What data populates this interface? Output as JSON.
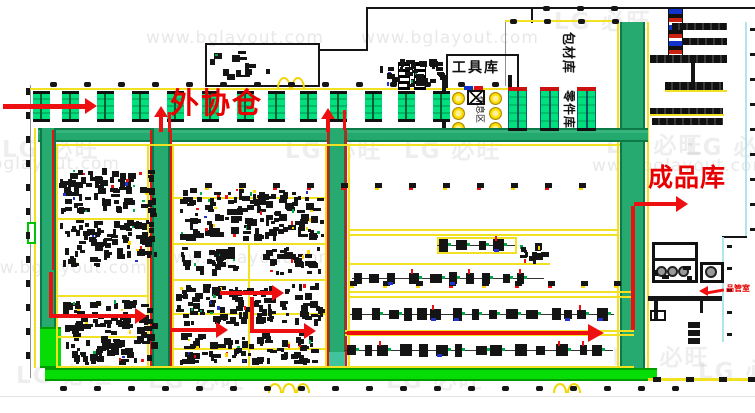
{
  "labels": {
    "outsourcing": "外协仓",
    "finished_goods": "成品库",
    "tools": "工具库",
    "packaging": "包材库",
    "parts": "零件库",
    "rest": "休息区",
    "quality": "品管室"
  },
  "watermark": {
    "url": "www.bglayout.com",
    "logo": "必旺",
    "url_positions": [
      [
        -58,
        154
      ],
      [
        146,
        28
      ],
      [
        361,
        28
      ],
      [
        592,
        156
      ],
      [
        -30,
        258
      ],
      [
        158,
        248
      ]
    ],
    "logo_positions": [
      [
        2,
        130
      ],
      [
        285,
        131
      ],
      [
        404,
        131
      ],
      [
        554,
        2
      ],
      [
        606,
        126
      ],
      [
        686,
        128
      ],
      [
        16,
        356
      ],
      [
        148,
        361
      ],
      [
        386,
        361
      ],
      [
        612,
        338
      ],
      [
        698,
        352
      ]
    ]
  },
  "colors": {
    "aisle_green": "#27aa70",
    "aisle_green_dark": "#0c7a47",
    "bright_green": "#06dc06",
    "zone_yellow": "#f2e120",
    "arrow_red": "#ee1010",
    "machine_green": "#00e07c",
    "accent_blue": "#2233cc",
    "accent_yellow": "#ffd700",
    "accent_dgreen": "#00aa44"
  },
  "top_machines": {
    "xs": [
      33,
      62,
      97,
      132,
      167,
      202,
      237,
      268,
      300,
      330,
      365,
      398,
      433
    ],
    "y": 91,
    "w": 17,
    "h": 31
  },
  "parts_machines": {
    "xs": [
      508,
      540,
      577
    ],
    "y": 87,
    "w": 19,
    "h": 44
  },
  "dot_rows": [
    {
      "y": 82,
      "x0": 50,
      "step": 34,
      "count": 14,
      "w": 7,
      "h": 5
    },
    {
      "y": 19,
      "x0": 510,
      "step": 34,
      "count": 4,
      "w": 7,
      "h": 5
    },
    {
      "y": 6,
      "x0": 543,
      "step": 34,
      "count": 3,
      "w": 7,
      "h": 5
    },
    {
      "y": 386,
      "x0": 60,
      "step": 34,
      "count": 19,
      "w": 7,
      "h": 5
    }
  ],
  "mark_rows": [
    {
      "y": 183,
      "x0": 205,
      "step": 34,
      "count": 12
    },
    {
      "y": 281,
      "x0": 350,
      "step": 33,
      "count": 9
    }
  ],
  "clusters": [
    {
      "x": 58,
      "y": 168,
      "w": 100,
      "h": 50,
      "type": "scatter",
      "seed": 11
    },
    {
      "x": 58,
      "y": 220,
      "w": 102,
      "h": 48,
      "type": "scatter",
      "seed": 22
    },
    {
      "x": 62,
      "y": 300,
      "w": 98,
      "h": 66,
      "type": "scatter",
      "seed": 33
    },
    {
      "x": 178,
      "y": 188,
      "w": 148,
      "h": 54,
      "type": "scatter",
      "seed": 44
    },
    {
      "x": 178,
      "y": 247,
      "w": 62,
      "h": 30,
      "type": "scatter",
      "seed": 55
    },
    {
      "x": 262,
      "y": 247,
      "w": 62,
      "h": 30,
      "type": "scatter",
      "seed": 66
    },
    {
      "x": 176,
      "y": 283,
      "w": 150,
      "h": 44,
      "type": "scatter",
      "seed": 77
    },
    {
      "x": 178,
      "y": 333,
      "w": 148,
      "h": 33,
      "type": "scatter",
      "seed": 88
    },
    {
      "x": 517,
      "y": 243,
      "w": 34,
      "h": 24,
      "type": "scatter",
      "seed": 99
    },
    {
      "x": 350,
      "y": 300,
      "w": 264,
      "h": 29,
      "type": "hline",
      "seed": 101
    },
    {
      "x": 345,
      "y": 336,
      "w": 268,
      "h": 29,
      "type": "hline",
      "seed": 102
    },
    {
      "x": 437,
      "y": 238,
      "w": 78,
      "h": 15,
      "type": "hline",
      "seed": 103
    },
    {
      "x": 352,
      "y": 267,
      "w": 192,
      "h": 23,
      "type": "hline",
      "seed": 104
    },
    {
      "x": 380,
      "y": 57,
      "w": 66,
      "h": 32,
      "type": "scatter",
      "seed": 105
    },
    {
      "x": 210,
      "y": 48,
      "w": 62,
      "h": 34,
      "type": "sparse",
      "seed": 106
    },
    {
      "x": 655,
      "y": 265,
      "w": 40,
      "h": 16,
      "type": "sparse",
      "seed": 107
    }
  ],
  "racks": [
    [
      672,
      23,
      55,
      7
    ],
    [
      683,
      38,
      44,
      7
    ],
    [
      650,
      55,
      77,
      8
    ],
    [
      665,
      82,
      58,
      8
    ],
    [
      650,
      108,
      73,
      8
    ],
    [
      652,
      118,
      71,
      7
    ]
  ],
  "rack_lines": [
    [
      665,
      90,
      62
    ],
    [
      650,
      114,
      74
    ]
  ],
  "right_ticks": [
    {
      "x": 750,
      "y0": 28,
      "step": 25,
      "count": 9
    },
    {
      "x": 727,
      "y0": 245,
      "step": 22,
      "count": 5
    }
  ],
  "left_dashes": {
    "x": 26,
    "y0": 88,
    "step": 24,
    "count": 12
  },
  "bottom_right_dashes": [
    653,
    686,
    719,
    748
  ]
}
